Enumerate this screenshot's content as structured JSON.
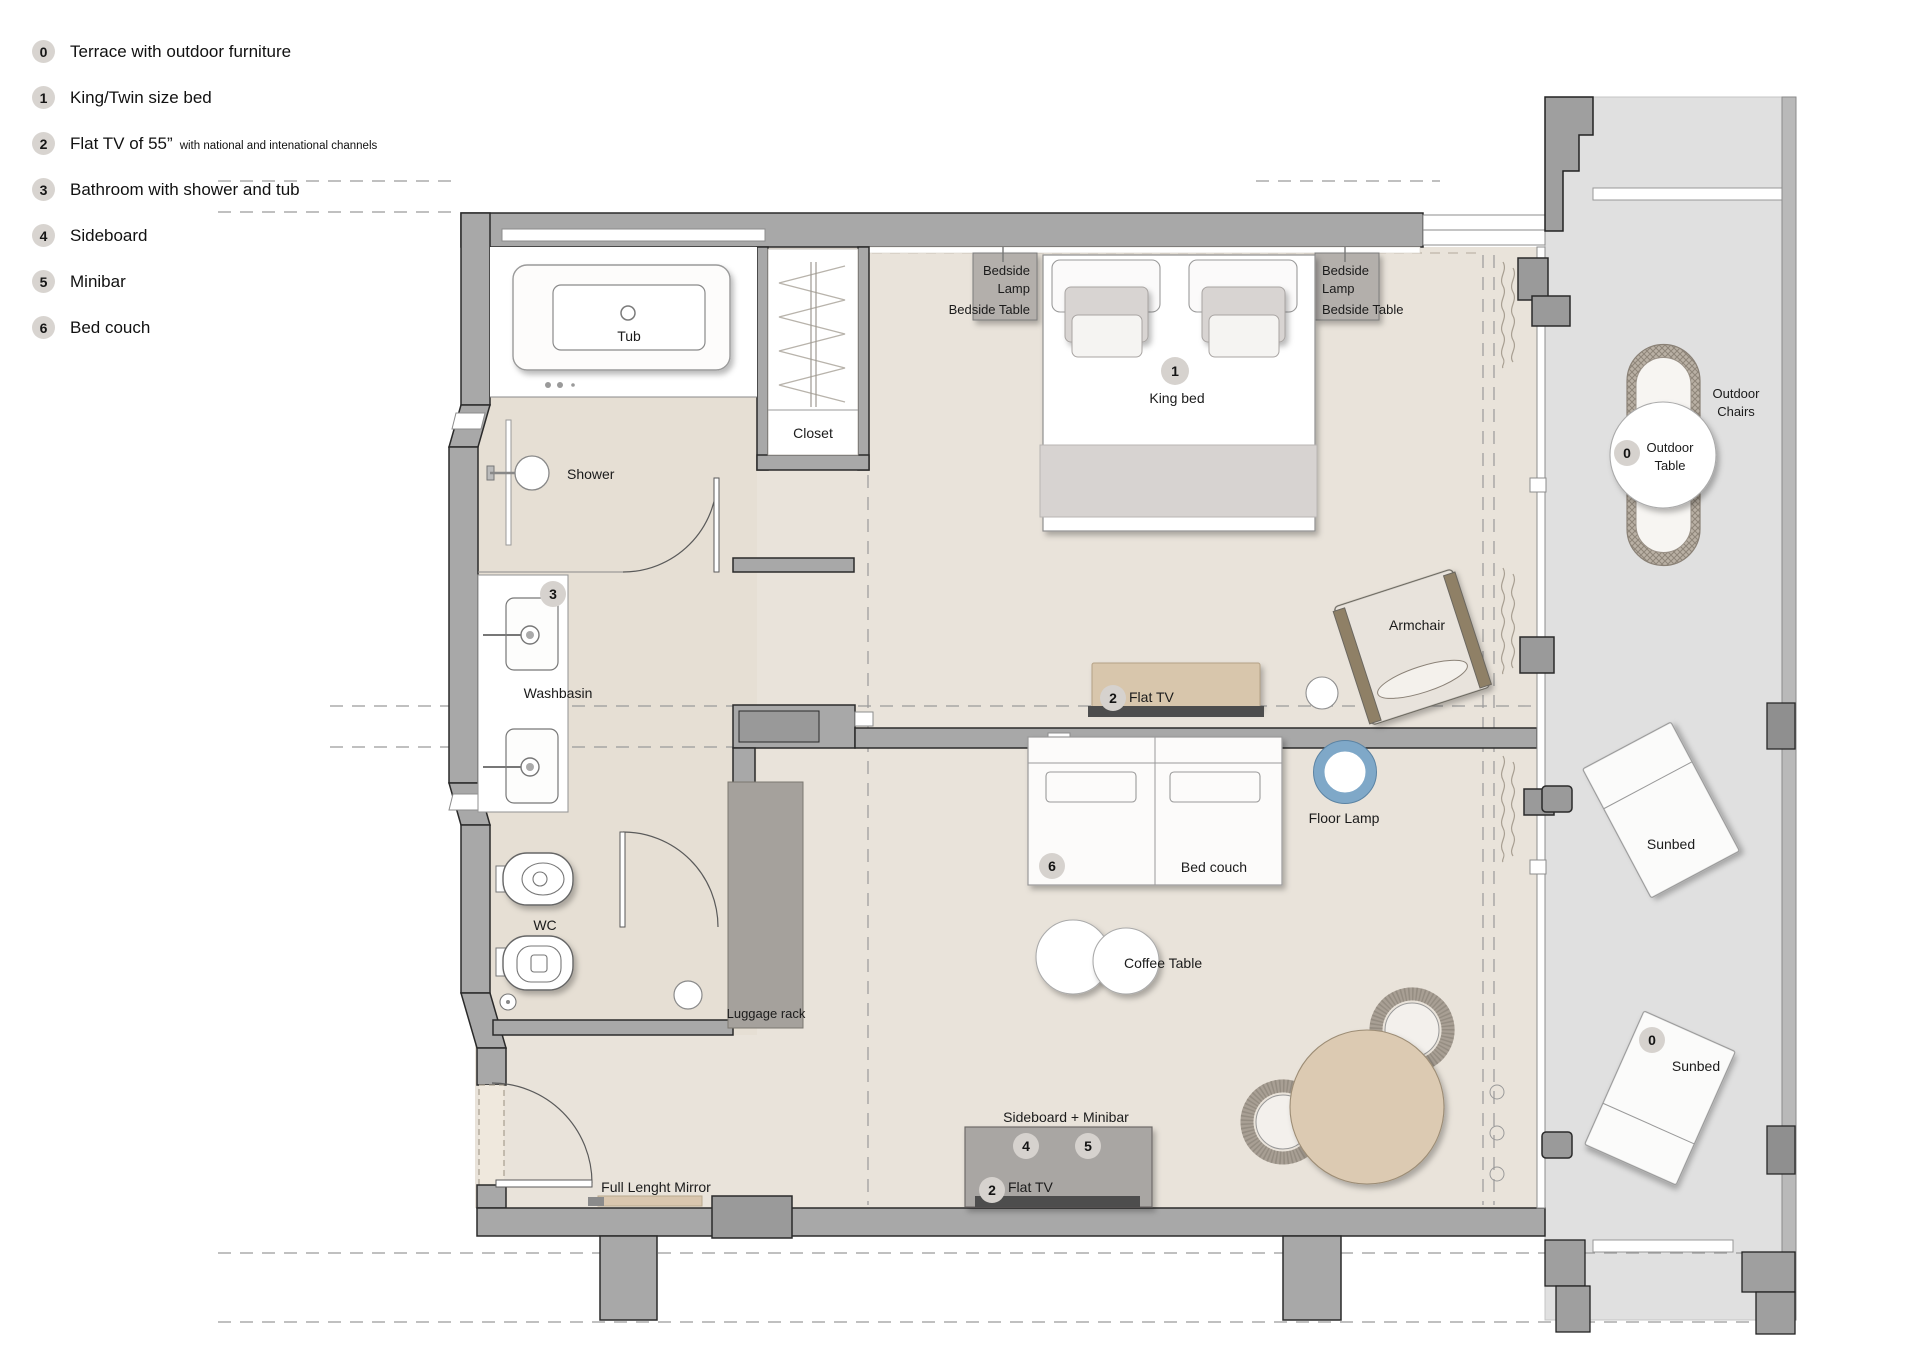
{
  "legend": {
    "items": [
      {
        "num": "0",
        "label": "Terrace with outdoor furniture",
        "note": ""
      },
      {
        "num": "1",
        "label": "King/Twin size bed",
        "note": ""
      },
      {
        "num": "2",
        "label": "Flat TV of 55”",
        "note": "with national and intenational channels"
      },
      {
        "num": "3",
        "label": "Bathroom with shower and tub",
        "note": ""
      },
      {
        "num": "4",
        "label": "Sideboard",
        "note": ""
      },
      {
        "num": "5",
        "label": "Minibar",
        "note": ""
      },
      {
        "num": "6",
        "label": "Bed couch",
        "note": ""
      }
    ]
  },
  "plan": {
    "bathroom": {
      "tub": "Tub",
      "shower": "Shower",
      "washbasin": "Washbasin",
      "washbasin_badge": "3",
      "wc": "WC"
    },
    "closet": "Closet",
    "bedroom": {
      "bedside_line1": "Bedside",
      "bedside_line2": "Lamp",
      "bedside_table": "Bedside Table",
      "king_bed": "King bed",
      "king_bed_badge": "1",
      "flat_tv": "Flat TV",
      "flat_tv_badge": "2",
      "armchair": "Armchair"
    },
    "living": {
      "floor_lamp": "Floor Lamp",
      "bed_couch": "Bed couch",
      "bed_couch_badge": "6",
      "coffee_table": "Coffee Table",
      "sideboard": "Sideboard + Minibar",
      "sideboard_badge": "4",
      "minibar_badge": "5",
      "flat_tv": "Flat TV",
      "flat_tv_badge": "2",
      "luggage_rack": "Luggage rack",
      "mirror": "Full Lenght Mirror"
    },
    "terrace": {
      "outdoor_table_line1": "Outdoor",
      "outdoor_table_line2": "Table",
      "outdoor_table_badge": "0",
      "outdoor_chairs_line1": "Outdoor",
      "outdoor_chairs_line2": "Chairs",
      "sunbed_top": "Sunbed",
      "sunbed_bottom": "Sunbed",
      "sunbed_badge": "0"
    }
  },
  "colors": {
    "wall": "#a8a8a8",
    "room_floor": "#e9e3da",
    "bathroom_floor": "#e6dfd4",
    "terrace_floor": "#e0e0e0",
    "accent_tan": "#d9c6ae",
    "tv_dark": "#4d4d4d",
    "lamp_blue": "#7fa8c8",
    "badge": "#d8d4d0",
    "blanket": "#d7d3d1",
    "dining_table": "#dccab2"
  }
}
